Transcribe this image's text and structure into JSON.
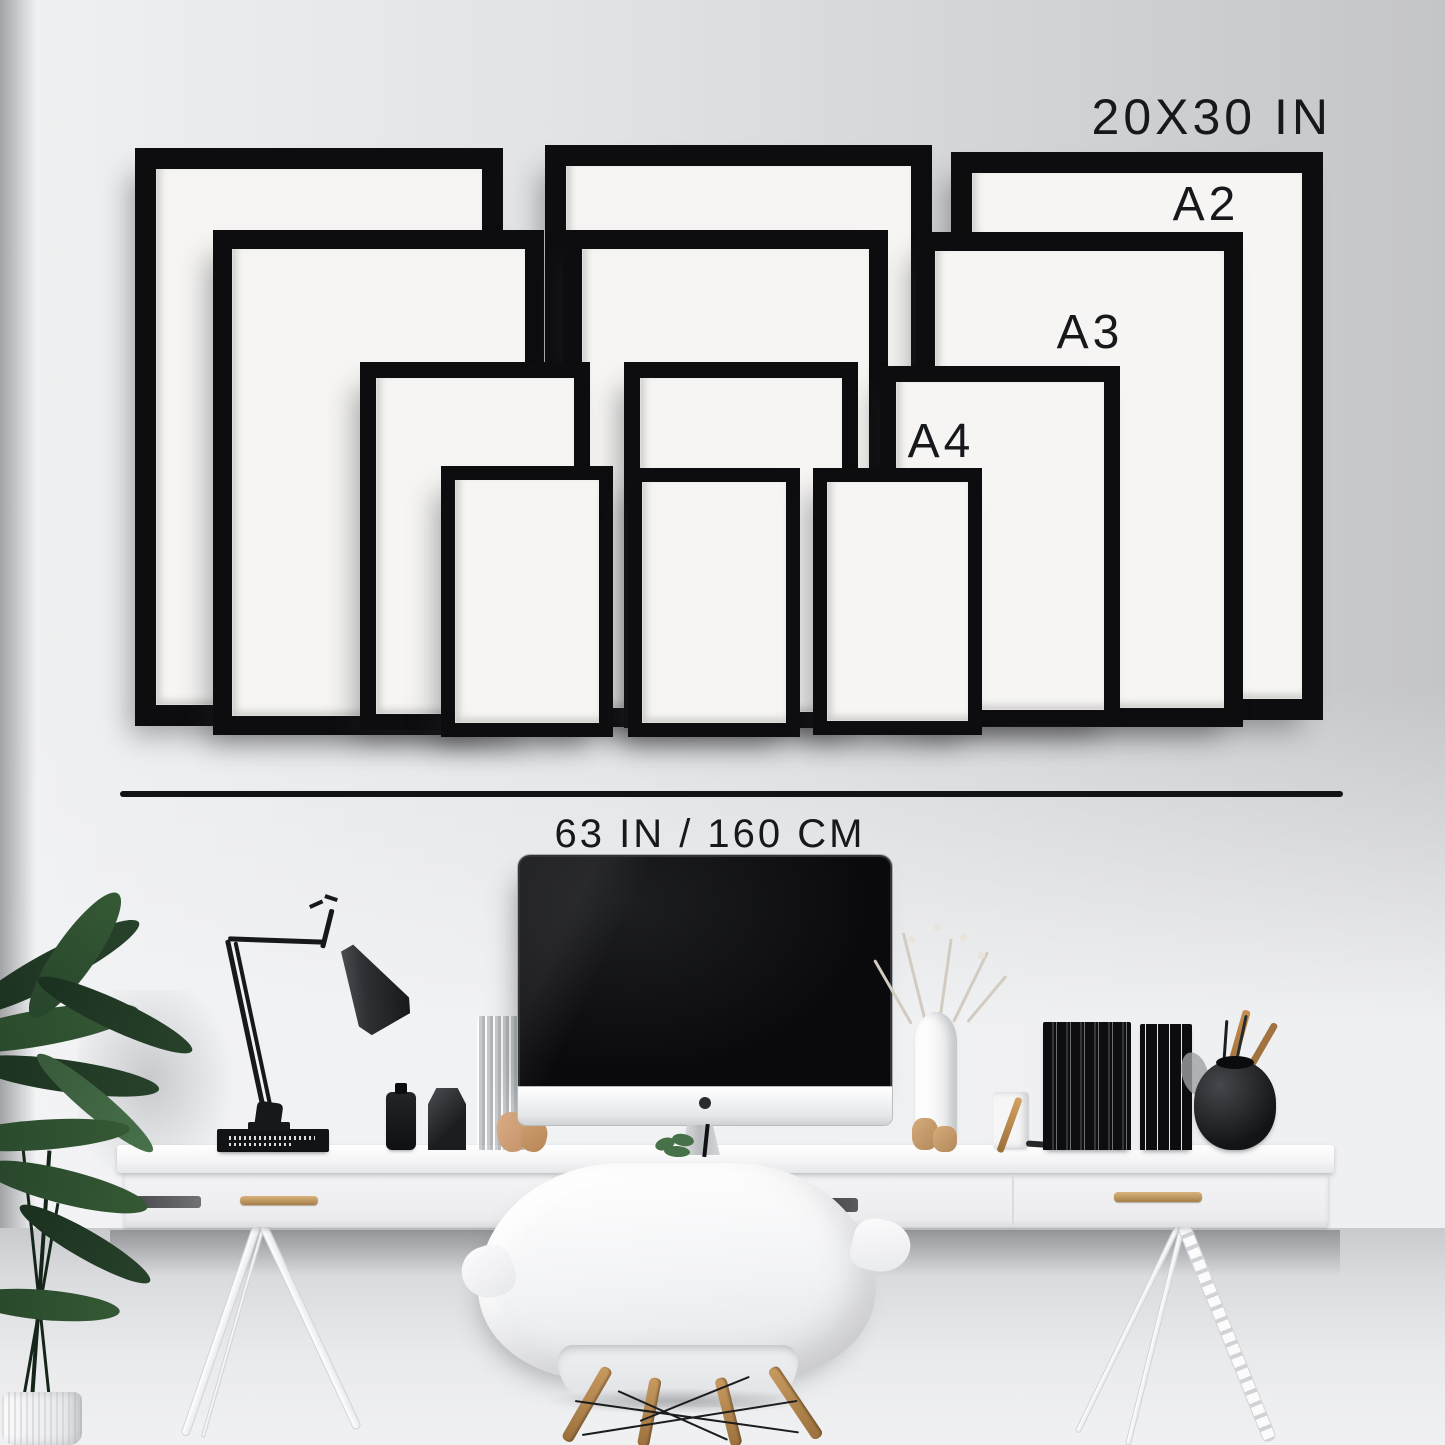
{
  "page": {
    "title": "Gallery wall frame size guide above white desk workspace"
  },
  "labels": {
    "size_20x30": "20X30 IN",
    "size_a2": "A2",
    "size_a3": "A3",
    "size_a4": "A4",
    "wall_width": "63 IN / 160 CM"
  },
  "frames": [
    {
      "column": "left",
      "size": "20x30 in"
    },
    {
      "column": "left",
      "size": "A2"
    },
    {
      "column": "left",
      "size": "A3"
    },
    {
      "column": "left",
      "size": "A4"
    },
    {
      "column": "middle",
      "size": "20x30 in"
    },
    {
      "column": "middle",
      "size": "A2"
    },
    {
      "column": "middle",
      "size": "A3"
    },
    {
      "column": "middle",
      "size": "A4"
    },
    {
      "column": "right",
      "size": "20x30 in"
    },
    {
      "column": "right",
      "size": "A2"
    },
    {
      "column": "right",
      "size": "A3"
    },
    {
      "column": "right",
      "size": "A4"
    }
  ],
  "colors": {
    "frame_black": "#0d0d0f",
    "mat_white": "#f6f5f3",
    "label_text": "#17181b",
    "divider": "#121316",
    "brass_handle": "#c09a62",
    "wood_leg": "#b5854e",
    "plant_green": "#2c4a2e"
  }
}
